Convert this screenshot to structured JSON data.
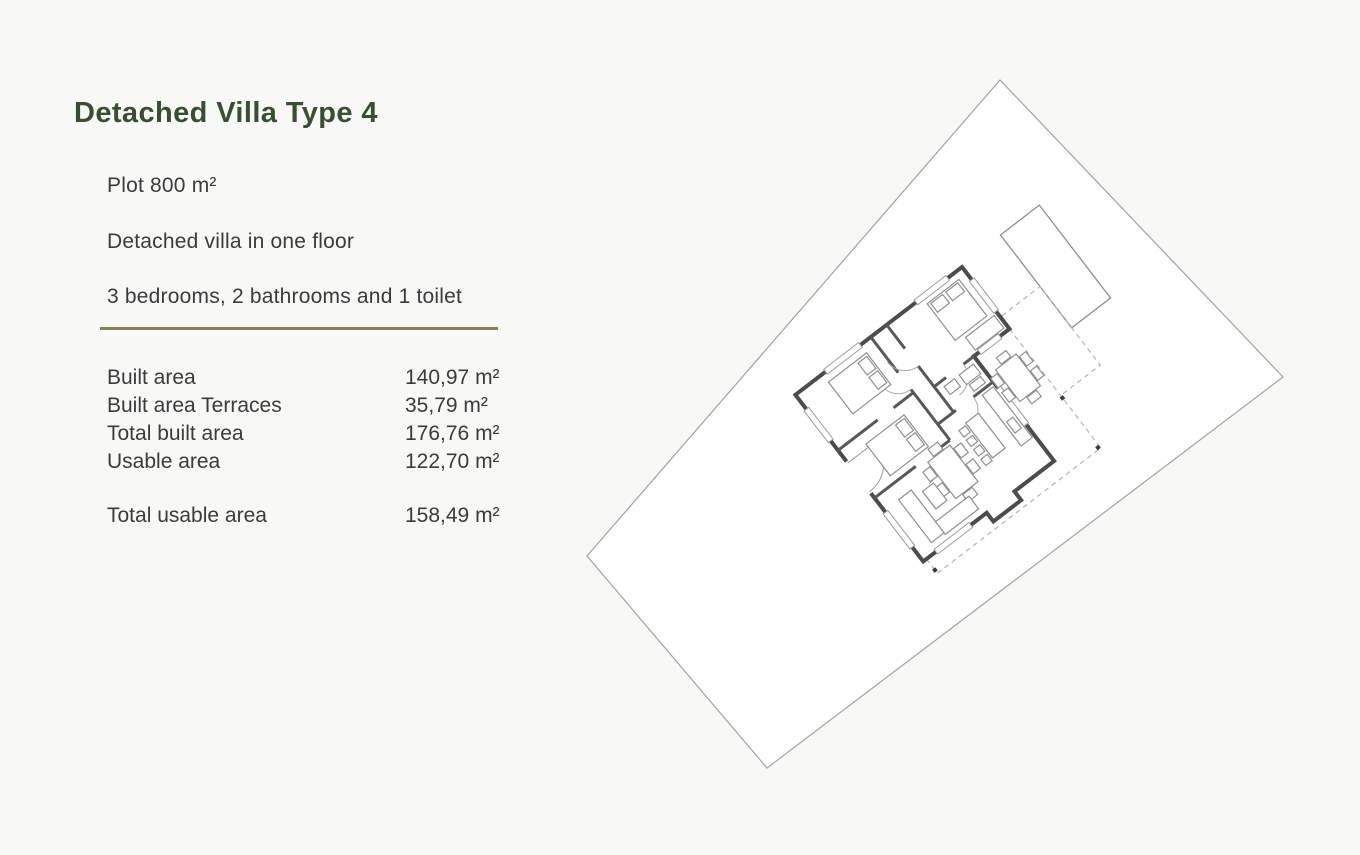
{
  "page": {
    "title": "Detached Villa Type 4"
  },
  "description": {
    "plot": "Plot 800 m²",
    "type": "Detached villa in one floor",
    "rooms": "3 bedrooms, 2 bathrooms and 1 toilet"
  },
  "areas": {
    "rows": [
      {
        "label": "Built area",
        "value": "140,97 m²"
      },
      {
        "label": "Built area Terraces",
        "value": "35,79 m²"
      },
      {
        "label": "Total built area",
        "value": "176,76 m²"
      },
      {
        "label": "Usable area",
        "value": "122,70 m²"
      }
    ],
    "total": {
      "label": "Total usable area",
      "value": "158,49 m²"
    }
  },
  "floorplan": {
    "elements": [
      "plot-boundary",
      "swimming-pool",
      "house-outline",
      "terrace-dashed-boundary",
      "porch-columns",
      "bedroom-beds",
      "dining-table",
      "outdoor-dining-table",
      "kitchen-island",
      "sofa"
    ],
    "rotation_deg": 52.5
  },
  "colors": {
    "background": "#f8f8f7",
    "title_green": "#3c4d35",
    "body_text": "#3b3b3b",
    "divider_olive": "#82825b",
    "plot_line": "#a3a3a3",
    "wall": "#4c4c4c",
    "furniture": "#909090",
    "dashed": "#b5b5b5"
  }
}
